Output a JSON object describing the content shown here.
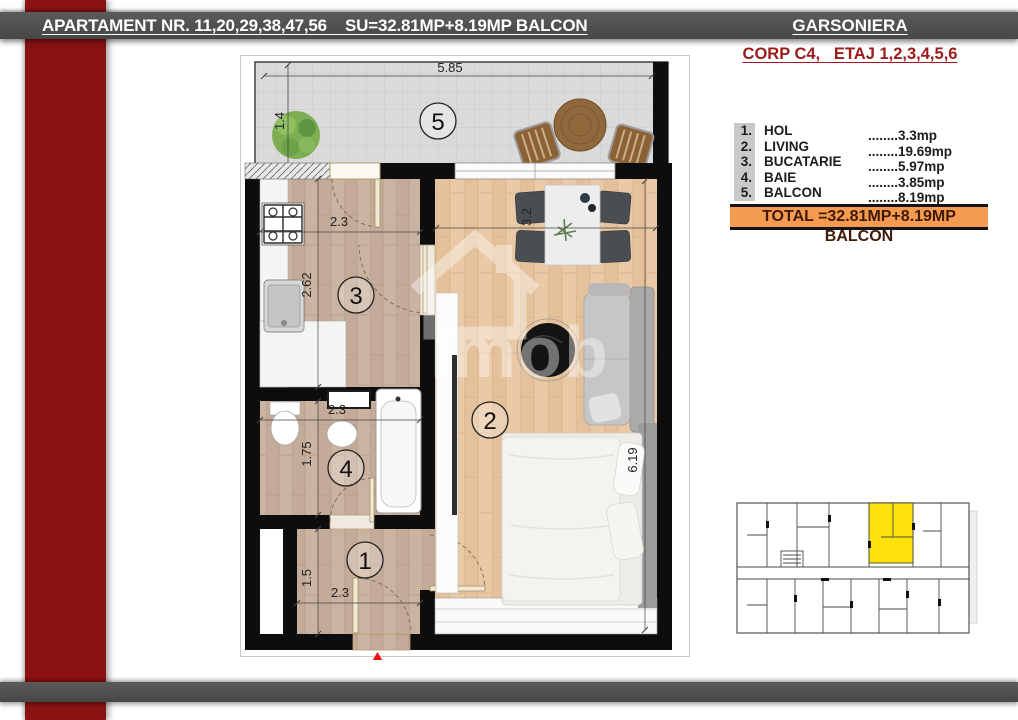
{
  "header": {
    "title": "APARTAMENT NR. 11,20,29,38,47,56    SU=32.81MP+8.19MP BALCON",
    "type_label": "GARSONIERA",
    "corp_line": "CORP C4,   ETAJ 1,2,3,4,5,6"
  },
  "legend": {
    "rows": [
      {
        "num": "1.",
        "name": "HOL",
        "value": "........3.3mp"
      },
      {
        "num": "2.",
        "name": "LIVING",
        "value": "........19.69mp"
      },
      {
        "num": "3.",
        "name": "BUCATARIE",
        "value": "........5.97mp"
      },
      {
        "num": "4.",
        "name": "BAIE",
        "value": "........3.85mp"
      },
      {
        "num": "5.",
        "name": "BALCON",
        "value": "........8.19mp"
      }
    ],
    "total": "TOTAL =32.81MP+8.19MP BALCON"
  },
  "plan": {
    "room_numbers": [
      "1",
      "2",
      "3",
      "4",
      "5"
    ],
    "dims": {
      "balcony_w": "5.85",
      "balcony_h": "1.4",
      "kitchen_w": "2.3",
      "kitchen_h": "2.62",
      "living_w": "3.2",
      "living_h": "6.19",
      "bath_w": "2.3",
      "bath_h": "1.75",
      "hall_w": "2.3",
      "hall_h": "1.5"
    },
    "watermark": "Imob"
  },
  "colors": {
    "accent_red": "#8C1212",
    "bar_gray": "#4F4F4F",
    "corp_red": "#9B1B1B",
    "total_orange": "#F59B51",
    "unit_highlight": "#FFE20A",
    "entry_marker": "#E91414"
  }
}
